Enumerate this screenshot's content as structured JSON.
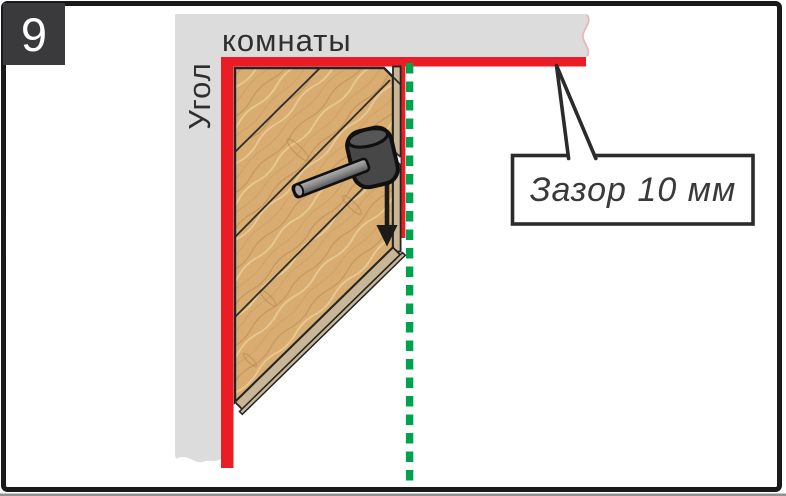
{
  "step": {
    "number": "9"
  },
  "labels": {
    "wall_vertical": "Угол",
    "wall_horizontal": "комнаты",
    "callout": "Зазор 10 мм"
  },
  "icons": {
    "mallet": "rubber-mallet-icon",
    "arrow_down": "arrow-down-icon"
  },
  "colors": {
    "red": "#EC1C24",
    "green": "#00A24D",
    "wall": "#DCDCDC",
    "wood": "#D9AD72",
    "edge": "#C9B697",
    "outline": "#1A1A1A",
    "badge": "#3A3A3C",
    "text": "#2F2F2F"
  }
}
